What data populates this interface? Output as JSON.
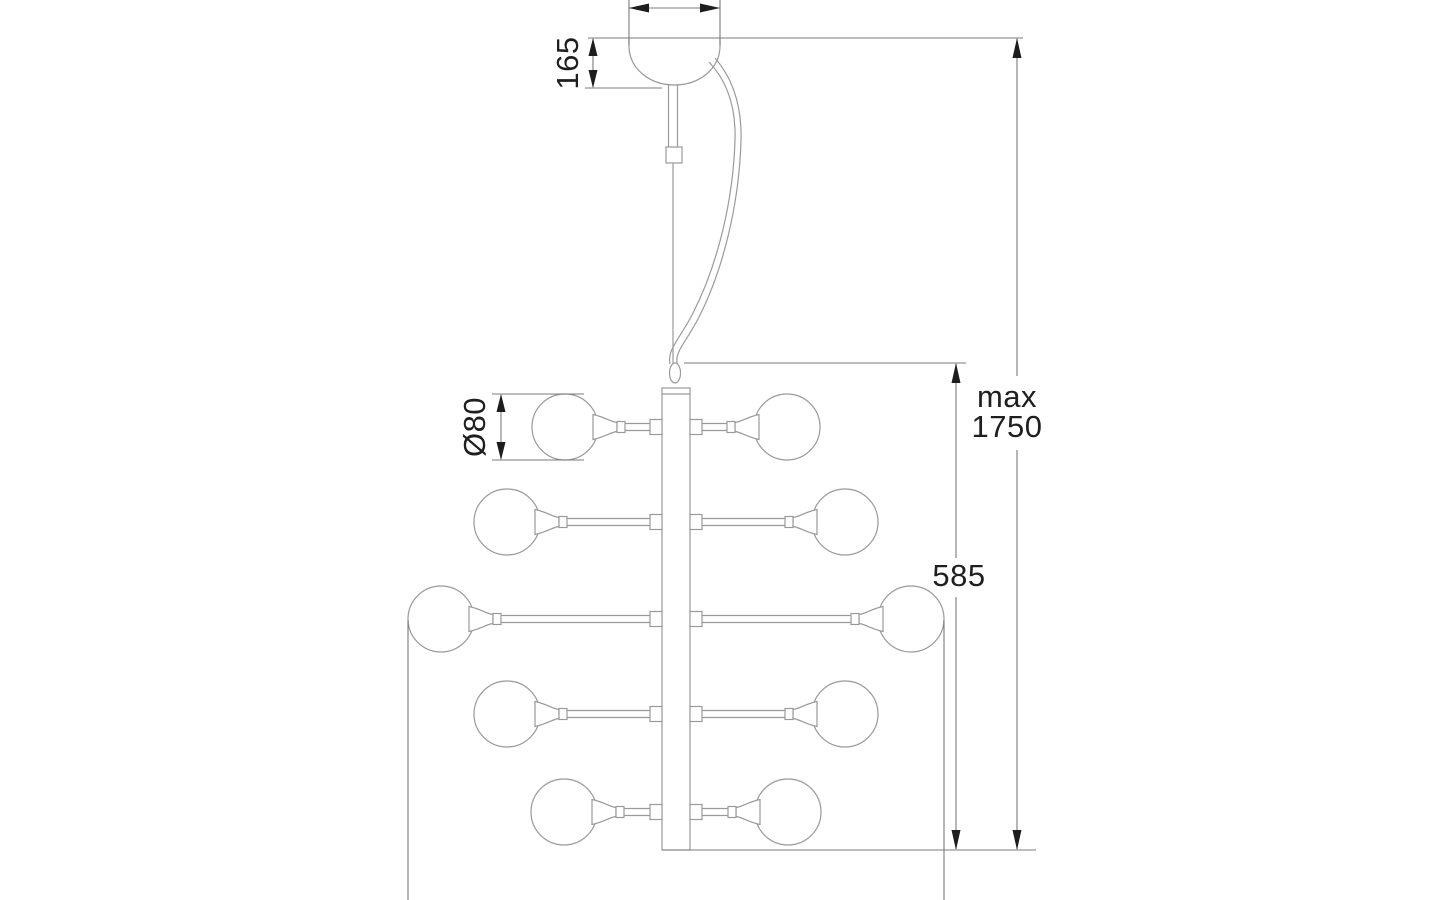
{
  "figure": {
    "type": "technical-dimension-drawing",
    "labels": {
      "canopy_height": "165",
      "globe_diameter": "Ø80",
      "body_height": "585",
      "max_drop_line1": "max",
      "max_drop_line2": "1750"
    },
    "colors": {
      "background": "#ffffff",
      "outline": "#9a9a9a",
      "dimension_line": "#7b7b7b",
      "arrow": "#1d1d1d",
      "text": "#1f1f1f"
    }
  }
}
